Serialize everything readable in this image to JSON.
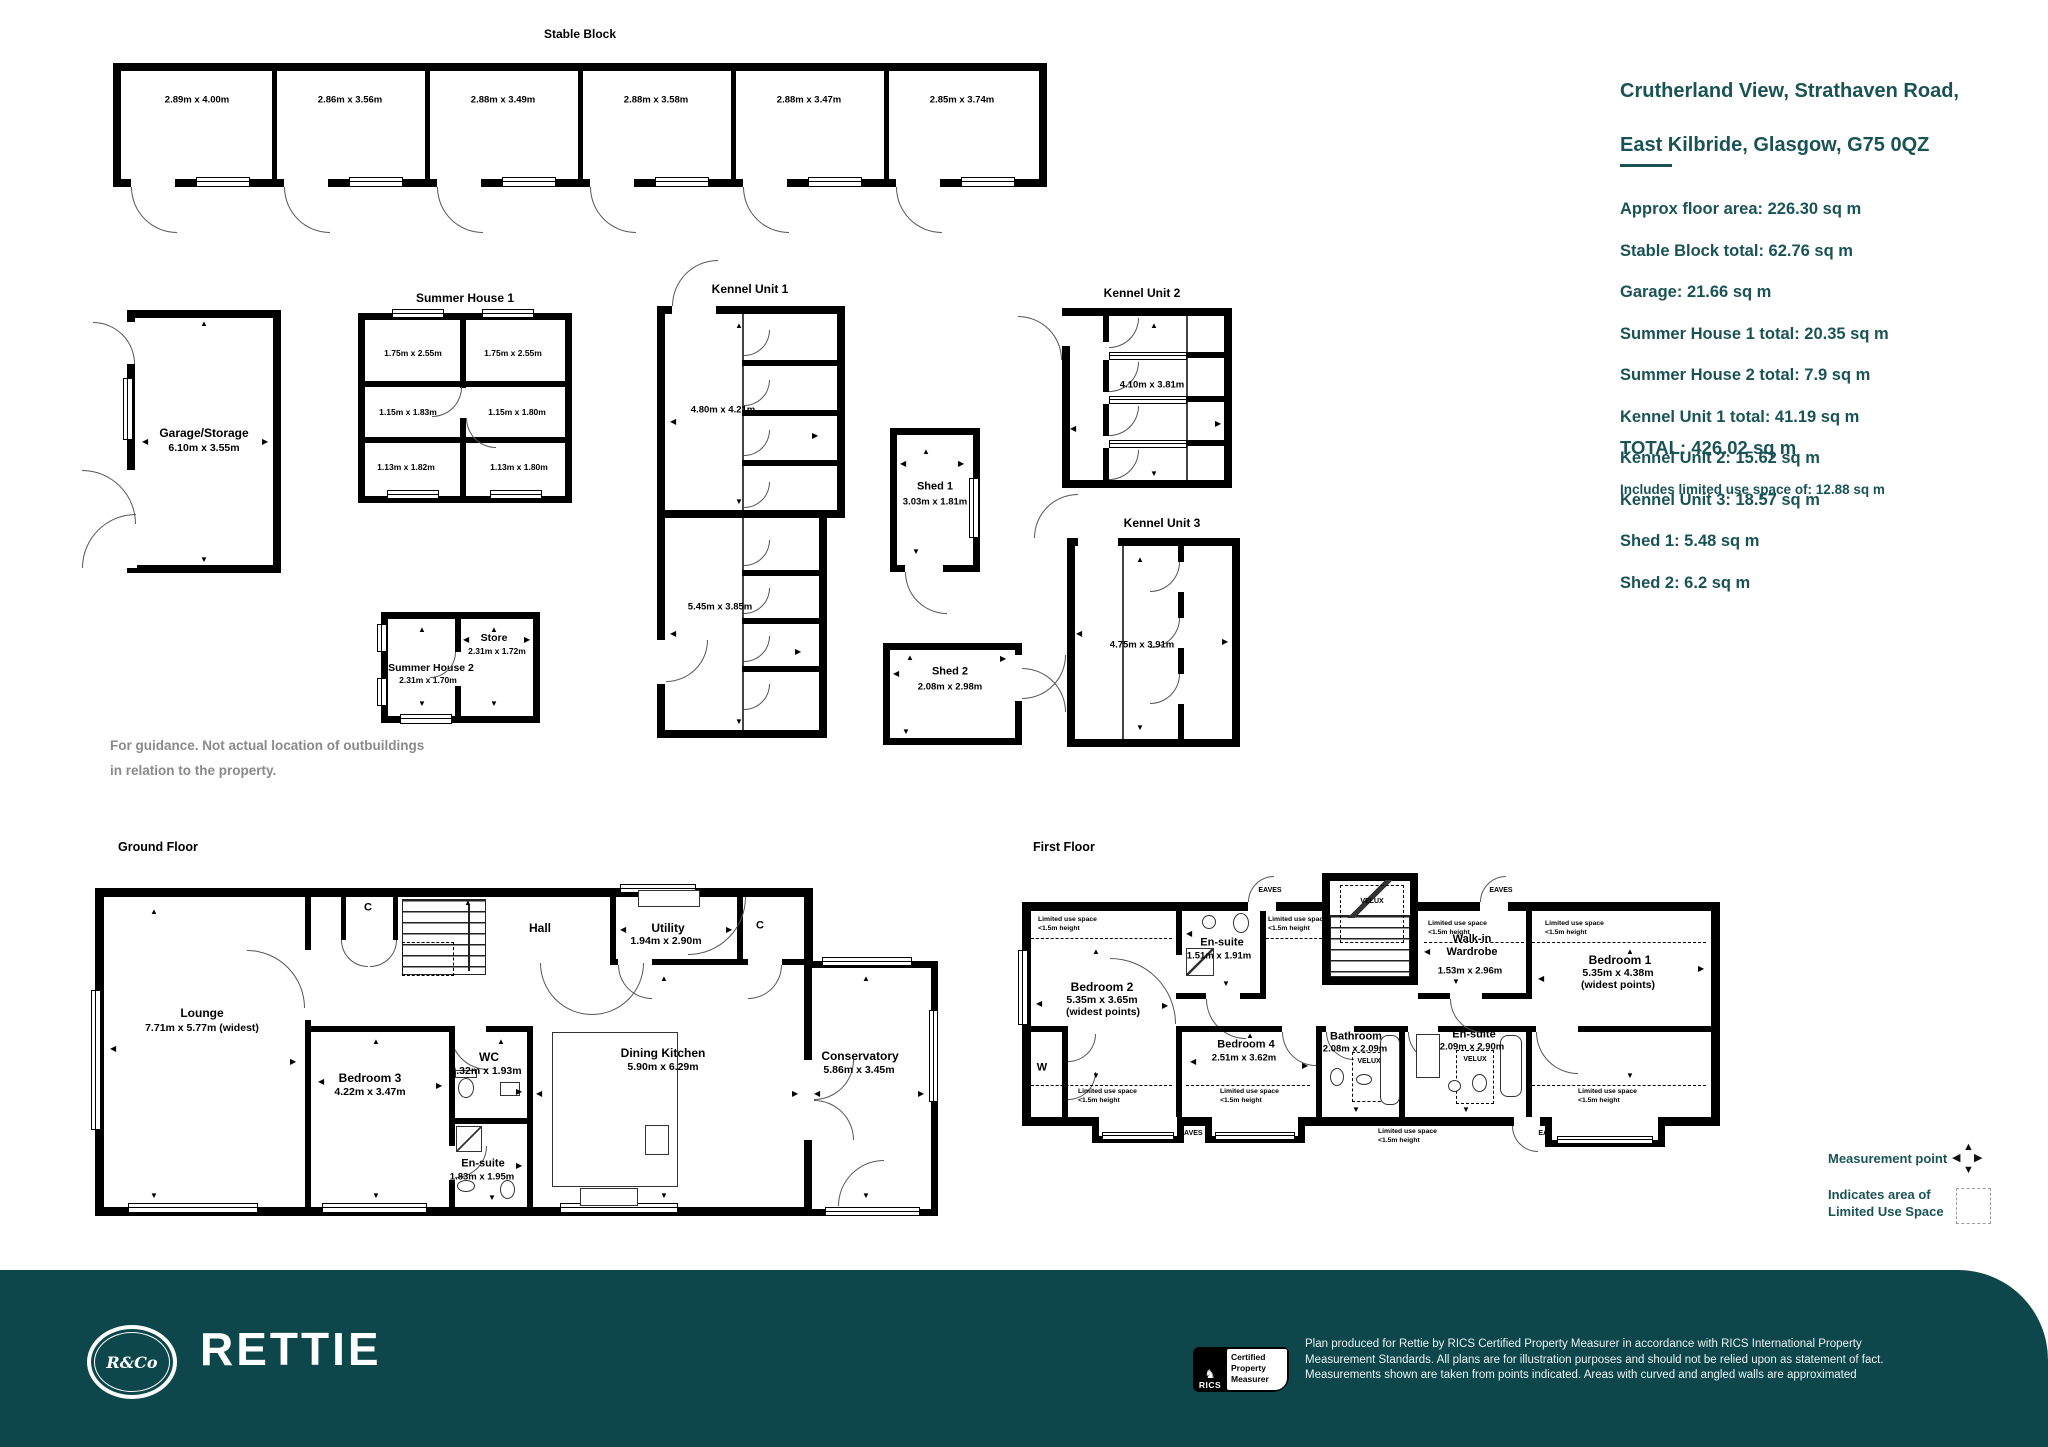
{
  "colors": {
    "accent_teal": "#1A5356",
    "footer_teal": "#0E474B"
  },
  "summary": {
    "address_line1": "Crutherland View, Strathaven Road,",
    "address_line2": "East Kilbride, Glasgow, G75 0QZ",
    "lines": [
      "Approx floor area: 226.30 sq m",
      "Stable Block total: 62.76 sq m",
      "Garage: 21.66 sq m",
      "Summer House 1 total: 20.35 sq m",
      "Summer House 2 total: 7.9 sq m",
      "Kennel Unit 1 total: 41.19 sq m",
      "Kennel Unit 2: 15.62 sq m",
      "Kennel Unit 3: 18.57 sq m",
      "Shed 1: 5.48 sq m",
      "Shed 2: 6.2 sq m"
    ],
    "total": "TOTAL: 426.02 sq m",
    "limited_note": "Includes limited use space of: 12.88 sq m"
  },
  "outbuildings": {
    "stable_block": {
      "title": "Stable Block",
      "stalls": [
        "2.89m x 4.00m",
        "2.86m x 3.56m",
        "2.88m x 3.49m",
        "2.88m x 3.58m",
        "2.88m x 3.47m",
        "2.85m x 3.74m"
      ]
    },
    "garage": {
      "name": "Garage/Storage",
      "dims": "6.10m x 3.55m"
    },
    "summer_house_1": {
      "title": "Summer House 1",
      "rooms": [
        "1.75m x 2.55m",
        "1.75m x 2.55m",
        "1.15m x 1.83m",
        "1.15m x 1.80m",
        "1.13m x 1.82m",
        "1.13m x 1.80m"
      ]
    },
    "kennel_unit_1": {
      "title": "Kennel Unit 1",
      "dims_upper": "4.80m x 4.21m",
      "dims_lower": "5.45m x 3.85m"
    },
    "kennel_unit_2": {
      "title": "Kennel Unit 2",
      "dims": "4.10m x 3.81m"
    },
    "kennel_unit_3": {
      "title": "Kennel Unit 3",
      "dims": "4.75m x 3.91m"
    },
    "shed_1": {
      "name": "Shed 1",
      "dims": "3.03m x 1.81m"
    },
    "shed_2": {
      "name": "Shed 2",
      "dims": "2.08m x 2.98m"
    },
    "summer_house_2": {
      "name": "Summer House 2",
      "dims": "2.31m x 1.70m",
      "store_name": "Store",
      "store_dims": "2.31m x 1.72m"
    },
    "guidance_note": "For guidance. Not actual location of outbuildings\nin relation to the property."
  },
  "ground_floor": {
    "title": "Ground Floor",
    "lounge_name": "Lounge",
    "lounge_dims": "7.71m x 5.77m (widest)",
    "bedroom3_name": "Bedroom 3",
    "bedroom3_dims": "4.22m x 3.47m",
    "wc_name": "WC",
    "wc_dims": "2.32m x 1.93m",
    "ensuite_name": "En-suite",
    "ensuite_dims": "1.83m x 1.95m",
    "hall_name": "Hall",
    "cupboard": "C",
    "utility_name": "Utility",
    "utility_dims": "1.94m x 2.90m",
    "dining_name": "Dining Kitchen",
    "dining_dims": "5.90m x 6.29m",
    "conservatory_name": "Conservatory",
    "conservatory_dims": "5.86m x 3.45m"
  },
  "first_floor": {
    "title": "First Floor",
    "bedroom2_name": "Bedroom 2",
    "bedroom2_dims": "5.35m x 3.65m",
    "widest_note": "(widest points)",
    "ensuite_top_name": "En-suite",
    "ensuite_top_dims": "1.51m x 1.91m",
    "bedroom4_name": "Bedroom 4",
    "bedroom4_dims": "2.51m x 3.62m",
    "bathroom_name": "Bathroom",
    "bathroom_dims": "2.08m x 2.09m",
    "ensuite_right_name": "En-suite",
    "ensuite_right_dims": "2.09m x 2.90m",
    "wardrobe_name": "Walk-in\nWardrobe",
    "wardrobe_dims": "1.53m x 2.96m",
    "bedroom1_name": "Bedroom 1",
    "bedroom1_dims": "5.35m x 4.38m",
    "w_label": "W",
    "eaves": "EAVES",
    "velux": "VELUX",
    "limited_use": "Limited use space\n<1.5m height"
  },
  "legend": {
    "measurement_point": "Measurement point",
    "limited_use_area": "Indicates area of\nLimited Use Space"
  },
  "footer": {
    "brand": "RETTIE",
    "monogram": "R&Co",
    "rics": "RICS",
    "badge": "Certified\nProperty\nMeasurer",
    "disclaimer": "Plan produced for Rettie by RICS Certified Property Measurer in accordance with RICS International Property\nMeasurement Standards.  All plans are for illustration purposes and should not be relied upon as statement of fact.\nMeasurements shown are taken from points indicated. Areas with curved and angled walls are approximated"
  }
}
